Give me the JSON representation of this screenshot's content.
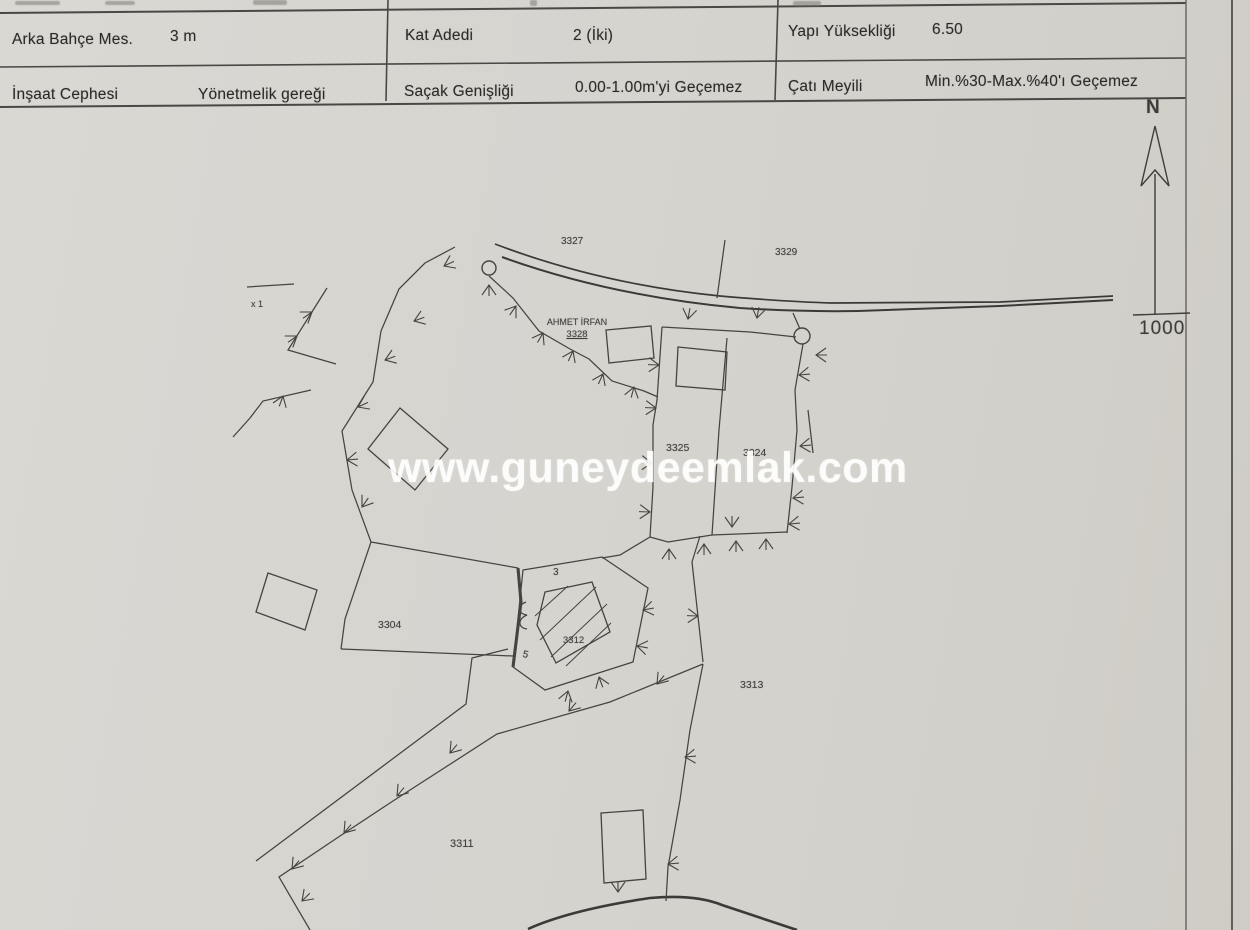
{
  "document": {
    "table": {
      "row1": {
        "label1": "Arka Bahçe Mes.",
        "value1": "3 m",
        "label2": "Kat Adedi",
        "value2": "2 (İki)",
        "label3": "Yapı Yüksekliği",
        "value3": "6.50"
      },
      "row2": {
        "label1": "İnşaat Cephesi",
        "value1": "Yönetmelik gereği",
        "label2": "Saçak Genişliği",
        "value2": "0.00-1.00m'yi Geçemez",
        "label3": "Çatı Meyili",
        "value3": "Min.%30-Max.%40'ı Geçemez"
      }
    },
    "map": {
      "parcel_3327": "3327",
      "parcel_3329": "3329",
      "owner_name": "AHMET İRFAN",
      "owner_parcel": "3328",
      "parcel_3325": "3325",
      "parcel_3324": "3324",
      "parcel_3304": "3304",
      "building_3312": "3312",
      "parcel_3313": "3313",
      "parcel_3311": "3311",
      "note_x1": "x 1",
      "dim_3": "3",
      "dim_5": "5",
      "north_label": "N",
      "scale_label": "1000"
    },
    "watermark": "www.guneydeemlak.com",
    "colors": {
      "paper": "#d6d4cf",
      "ink": "#3f3e3b",
      "watermark": "#ffffff"
    }
  }
}
